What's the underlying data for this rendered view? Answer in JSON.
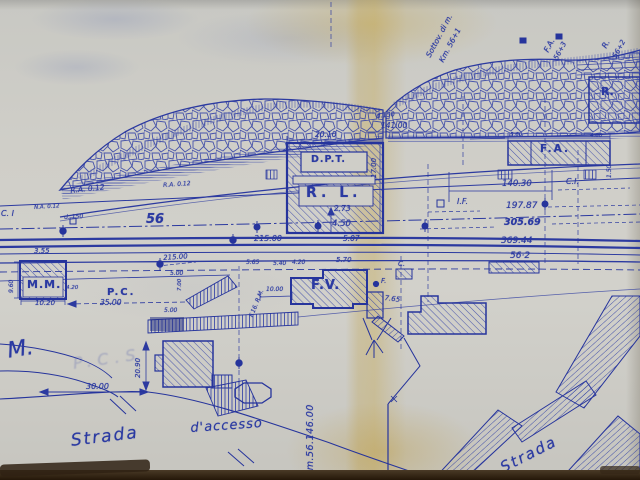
{
  "colors": {
    "ink": "#2c3aa0",
    "ink_dark": "#222f96",
    "paper": "#cfcec8",
    "fold_stain": "#c6a654",
    "photo_border": "#2a1c10"
  },
  "labels": {
    "sottovia1": "Sottov. di m.",
    "sottovia2": "Km. 56+1",
    "fa_diag1": "F.A.",
    "fa_diag2": "56+3",
    "r_diag1": "R.",
    "r_diag2": "56+2",
    "r_box": "R.",
    "d150_top": "d.150",
    "dim_141": "141.00",
    "dim_2010": "20.10",
    "dim_1700": "17.00",
    "dpt": "D.P.T.",
    "rl": "R. L.",
    "dim_273": "2.73",
    "dim_450": "4.50",
    "dim_21500_c": "215.00",
    "dim_507": "5.07",
    "fa_box": "F.A.",
    "dim_560": "5.60",
    "dim_460": "4.60",
    "dim_14030": "140.30",
    "ci_right": "C.I.",
    "if_mark": "I.F.",
    "dim_19787": "197.87",
    "dim_30569": "305.69",
    "dim_36944": "369.44",
    "hm_562": "56·2",
    "dim_150v": "1.50",
    "ra_012_a": "R.A. 0.12",
    "na_012": "N.A. 0.12",
    "ra_012_b": "R.A. 0.12",
    "ci_left": "C. I",
    "d150_left": "d. 150",
    "hm_56": "56",
    "dim_355": "3.55",
    "dim_960": "9.60",
    "mm": "M.M.",
    "dim_1020": "10.20",
    "dim_420a": "4.20",
    "pc": "P.C.",
    "dim_3500": "35.00",
    "dim_21500_l": "215.00",
    "dim_500a": "5.00",
    "dim_700": "7.00",
    "dim_500b": "5.00",
    "dim_1000": "10.00",
    "f16rm": "F.16. R.M.",
    "dim_565": "5.65",
    "dim_540": "5.40",
    "dim_420b": "4.20",
    "dim_570": "5.70",
    "fv": "F.V.",
    "c_small": "C.",
    "f_small": "F.",
    "dim_765": "7.65",
    "m_cursive": "M.",
    "ghost_pcs": "P.C.S",
    "dim_2090": "20.90",
    "dim_3000": "30.00",
    "strada1": "Strada",
    "daccesso": "d'accesso",
    "km_post": "Km.56.146.00",
    "strada2": "Strada"
  }
}
